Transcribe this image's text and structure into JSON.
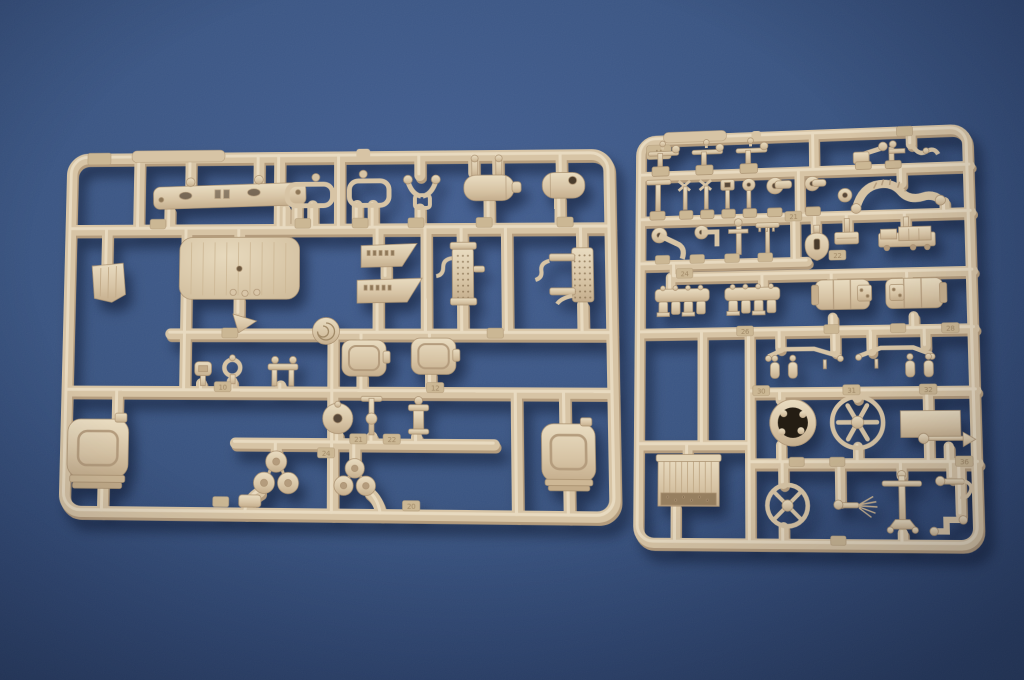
{
  "scene": {
    "description": "Product photograph of two tan injection-molded plastic model kit sprues (part trees) lying on textured dark blue paper, lit softly from the upper left with drop shadows falling to the lower right.",
    "background": {
      "base_color": "#35507f",
      "center_glow": "#3f5b8e",
      "edge_vignette": "#263b61"
    },
    "plastic": {
      "base": "#d7c4a5",
      "highlight": "#ecdfc5",
      "shadow": "#b49c7d",
      "hole_dark": "#574839"
    }
  },
  "left_sprue": {
    "note": "large sprue, frame letter not readable",
    "tags": [
      {
        "label": "10"
      },
      {
        "label": "12"
      },
      {
        "label": "21"
      },
      {
        "label": "22"
      },
      {
        "label": "24"
      },
      {
        "label": "20"
      }
    ],
    "parts": [
      "front brace bar",
      "ribbed roof panel",
      "mud flap",
      "window frame",
      "window frame",
      "handle bracket",
      "twin-prong air tank",
      "drilled air tank",
      "tread plate",
      "tread plate",
      "radiator core with pipes",
      "radiator core with pipes",
      "coiled ring",
      "hinged hatch cover",
      "hinged hatch cover",
      "cap post",
      "ring post",
      "bench bracket",
      "domed cap",
      "tee post",
      "cable spool",
      "reel cluster",
      "reel cluster",
      "fuel can",
      "fuel can",
      "stowage wedge",
      "rail block"
    ]
  },
  "right_sprue": {
    "corner_mark": "H",
    "tags": [
      {
        "label": "21"
      },
      {
        "label": "22"
      },
      {
        "label": "24"
      },
      {
        "label": "26"
      },
      {
        "label": "28"
      },
      {
        "label": "30"
      },
      {
        "label": "31"
      },
      {
        "label": "32"
      },
      {
        "label": "36"
      }
    ],
    "parts": [
      "signal lever",
      "signal lever",
      "signal lever",
      "crank arm",
      "post arm",
      "s-hook",
      "corner hose",
      "tee handle",
      "cross valve",
      "cross valve",
      "box valve",
      "round valve",
      "flanged elbow",
      "flanged elbow",
      "ribbed hose",
      "crank elbow",
      "pipe elbow",
      "tee post",
      "rake arm",
      "spade",
      "strap plate",
      "receiver box",
      "exhaust manifold",
      "exhaust manifold",
      "pump cylinder",
      "pump cylinder",
      "axle tree with bottles",
      "axle tree with bottles",
      "corrugated crate",
      "ring drum",
      "six-spoke fan",
      "flat plate",
      "cone rod",
      "steering wheel",
      "brush rod",
      "jack stand",
      "hook rod",
      "z-pipe"
    ]
  }
}
